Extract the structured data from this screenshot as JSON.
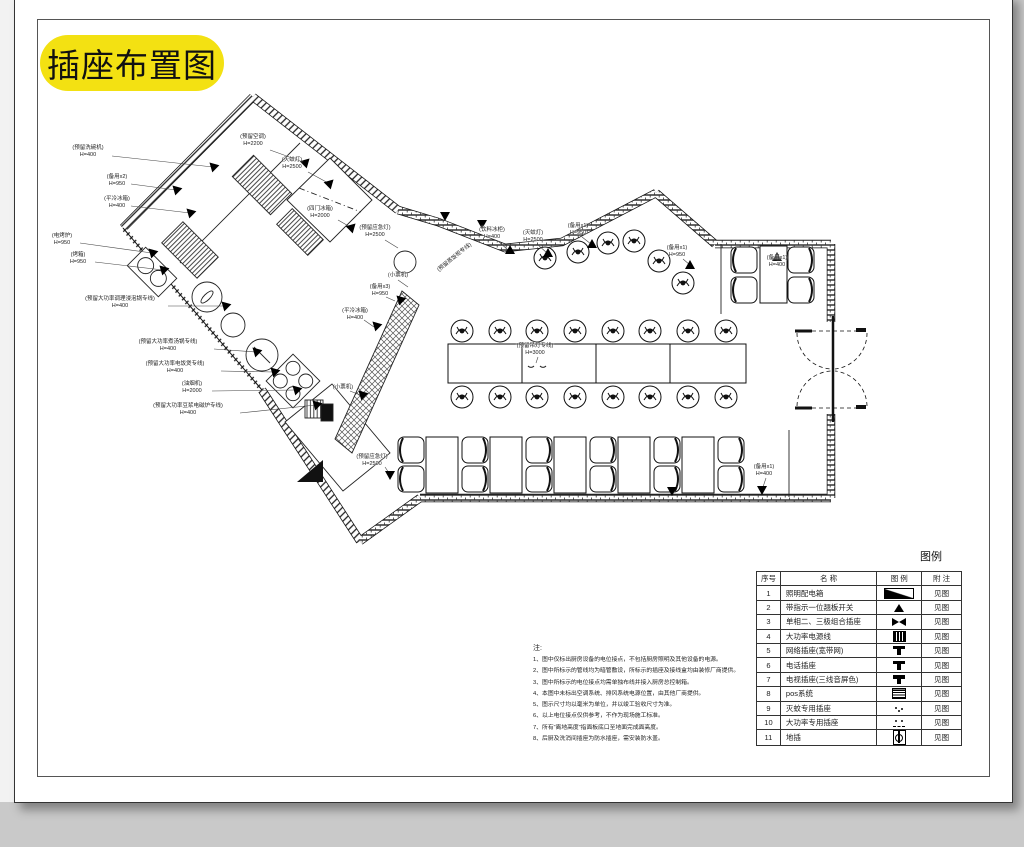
{
  "title": {
    "text": "插座布置图"
  },
  "legend": {
    "title": "图例",
    "headers": [
      "序号",
      "名  称",
      "图  例",
      "附  注"
    ],
    "rows": [
      {
        "no": "1",
        "name": "照明配电箱",
        "symbol": "distribution-box",
        "note": "见图"
      },
      {
        "no": "2",
        "name": "带指示一位翘板开关",
        "symbol": "rocker-switch",
        "note": "见图"
      },
      {
        "no": "3",
        "name": "单相二、三极组合插座",
        "symbol": "combo-socket",
        "note": "见图"
      },
      {
        "no": "4",
        "name": "大功率电源线",
        "symbol": "high-power-line",
        "note": "见图"
      },
      {
        "no": "5",
        "name": "网络插座(宽带网)",
        "symbol": "network-socket",
        "note": "见图"
      },
      {
        "no": "6",
        "name": "电话插座",
        "symbol": "phone-socket",
        "note": "见图"
      },
      {
        "no": "7",
        "name": "电视插座(三线音屏色)",
        "symbol": "tv-socket",
        "note": "见图"
      },
      {
        "no": "8",
        "name": "pos系统",
        "symbol": "pos-system",
        "note": "见图"
      },
      {
        "no": "9",
        "name": "灭蚊专用插座",
        "symbol": "mosquito-socket",
        "note": "见图"
      },
      {
        "no": "10",
        "name": "大功率专用插座",
        "symbol": "high-power-socket",
        "note": "见图"
      },
      {
        "no": "11",
        "name": "地插",
        "symbol": "floor-socket",
        "note": "见图"
      }
    ]
  },
  "notes": {
    "title": "注:",
    "items": [
      "1、图中仅标出厨房设备的电位接点，不包括厨房照明及其他设备的电源。",
      "2、图中所标示的管线均为暗管敷设，所标示的插座及接线盒均由装修厂商提供。",
      "3、图中所标示的电位接点均需单独布线并接入厨房总控制箱。",
      "4、本图中未标出空调系统、排风系统电源位置，由其他厂商提供。",
      "5、图示尺寸均以毫米为单位，并以竣工验收尺寸为准。",
      "6、以上电位接点仅供参考，不作为现场施工标准。",
      "7、所有“离地高度”指面板底口至地面完成面高度。",
      "8、后厨及洗消间插座为防水插座，需安装防水盖。"
    ]
  },
  "plan_labels": [
    {
      "t": "(预留洗碗机)",
      "s": "H=400",
      "x": 88,
      "y": 152
    },
    {
      "t": "(备用x2)",
      "s": "H=950",
      "x": 117,
      "y": 181
    },
    {
      "t": "(平冷冰箱)",
      "s": "H=400",
      "x": 117,
      "y": 203
    },
    {
      "t": "(电烤炉)",
      "s": "H=950",
      "x": 62,
      "y": 240
    },
    {
      "t": "(烤箱)",
      "s": "H=950",
      "x": 78,
      "y": 259
    },
    {
      "t": "(预留大功率调理浸泡锅专线)",
      "s": "H=400",
      "x": 120,
      "y": 303
    },
    {
      "t": "(预留大功率煮汤锅专线)",
      "s": "H=400",
      "x": 168,
      "y": 346
    },
    {
      "t": "(预留大功率电饭煲专线)",
      "s": "H=400",
      "x": 175,
      "y": 368
    },
    {
      "t": "(油烟机)",
      "s": "H=2000",
      "x": 192,
      "y": 388
    },
    {
      "t": "(预留大功率豆浆电磁炉专线)",
      "s": "H=400",
      "x": 188,
      "y": 410
    },
    {
      "t": "(预留空调)",
      "s": "H=2200",
      "x": 253,
      "y": 141
    },
    {
      "t": "(灭蚊灯)",
      "s": "H=2500",
      "x": 292,
      "y": 164
    },
    {
      "t": "(四门冰箱)",
      "s": "H=2000",
      "x": 320,
      "y": 213
    },
    {
      "t": "(预留应急灯)",
      "s": "H=2500",
      "x": 375,
      "y": 232
    },
    {
      "t": "(预留蒸饭柜专线)",
      "s": "",
      "x": 455,
      "y": 258,
      "rot": 1
    },
    {
      "t": "(饮料冰柜)",
      "s": "H=400",
      "x": 492,
      "y": 234
    },
    {
      "t": "(灭蚊灯)",
      "s": "H=2500",
      "x": 533,
      "y": 237
    },
    {
      "t": "(备用x1)",
      "s": "H=950",
      "x": 578,
      "y": 230
    },
    {
      "t": "(备用x1)",
      "s": "H=950",
      "x": 677,
      "y": 252
    },
    {
      "t": "(备用x1)",
      "s": "H=400",
      "x": 777,
      "y": 262
    },
    {
      "t": "(小票机)",
      "s": "",
      "x": 398,
      "y": 276
    },
    {
      "t": "(备用x3)",
      "s": "H=950",
      "x": 380,
      "y": 291
    },
    {
      "t": "(平冷冰箱)",
      "s": "H=400",
      "x": 355,
      "y": 315
    },
    {
      "t": "(小票机)",
      "s": "",
      "x": 343,
      "y": 388
    },
    {
      "t": "(预留吊灯专线)",
      "s": "H=3000",
      "x": 535,
      "y": 350
    },
    {
      "t": "(预留应急灯)",
      "s": "H=2500",
      "x": 372,
      "y": 461
    },
    {
      "t": "(备用x1)",
      "s": "H=400",
      "x": 764,
      "y": 471
    }
  ]
}
